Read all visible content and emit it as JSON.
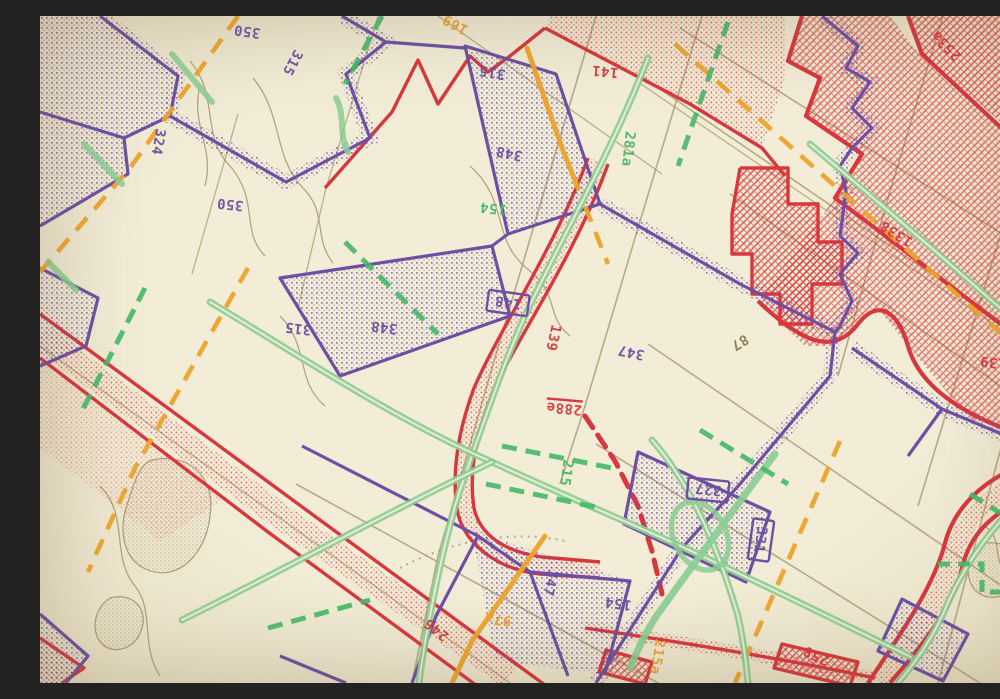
{
  "image": {
    "alt": "Close-up photograph of a printed zoning map with purple, red, green and orange district boundaries, halftone fills, dashed lines and rotated district numbers on cream paper",
    "width": 1000,
    "height": 667
  },
  "palette": {
    "paper": "#f3edd8",
    "paper_edge": "#e6ddc2",
    "purple": "#6f4fa3",
    "red": "#d8383d",
    "green": "#45b868",
    "green_road": "#8acd93",
    "orange": "#eca32d",
    "tan": "#a89870",
    "tan_dark": "#8a7c55"
  },
  "labels": [
    {
      "text": "350",
      "x": 207,
      "y": 16,
      "rot": 188,
      "color": "purple"
    },
    {
      "text": "315",
      "x": 253,
      "y": 47,
      "rot": 118,
      "color": "purple"
    },
    {
      "text": "324",
      "x": 119,
      "y": 126,
      "rot": 100,
      "color": "purple"
    },
    {
      "text": "350",
      "x": 190,
      "y": 189,
      "rot": 186,
      "color": "purple"
    },
    {
      "text": "169",
      "x": 415,
      "y": 9,
      "rot": 208,
      "color": "orange"
    },
    {
      "text": "315",
      "x": 452,
      "y": 57,
      "rot": 190,
      "color": "purple"
    },
    {
      "text": "141",
      "x": 565,
      "y": 56,
      "rot": 186,
      "color": "red"
    },
    {
      "text": "253a",
      "x": 906,
      "y": 30,
      "rot": 225,
      "color": "red"
    },
    {
      "text": "348",
      "x": 469,
      "y": 138,
      "rot": 192,
      "color": "purple"
    },
    {
      "text": "154",
      "x": 453,
      "y": 193,
      "rot": 186,
      "color": "green"
    },
    {
      "text": "281a",
      "x": 589,
      "y": 133,
      "rot": 96,
      "color": "green"
    },
    {
      "text": "315",
      "x": 258,
      "y": 313,
      "rot": 187,
      "color": "purple"
    },
    {
      "text": "348",
      "x": 344,
      "y": 312,
      "rot": 187,
      "color": "purple"
    },
    {
      "text": "148",
      "x": 468,
      "y": 287,
      "rot": 188,
      "color": "purple",
      "boxed": true
    },
    {
      "text": "139",
      "x": 514,
      "y": 322,
      "rot": 102,
      "color": "red"
    },
    {
      "text": "347",
      "x": 591,
      "y": 337,
      "rot": 192,
      "color": "purple"
    },
    {
      "text": "288e",
      "x": 524,
      "y": 393,
      "rot": 185,
      "color": "red",
      "underline": true
    },
    {
      "text": "87",
      "x": 700,
      "y": 327,
      "rot": 148,
      "color": "tan"
    },
    {
      "text": "1338",
      "x": 856,
      "y": 218,
      "rot": 212,
      "color": "red"
    },
    {
      "text": "139",
      "x": 953,
      "y": 347,
      "rot": 186,
      "color": "red"
    },
    {
      "text": "356",
      "x": 977,
      "y": 424,
      "rot": 190,
      "color": "purple"
    },
    {
      "text": "327",
      "x": 668,
      "y": 474,
      "rot": 186,
      "color": "purple",
      "boxed": true
    },
    {
      "text": "331",
      "x": 721,
      "y": 524,
      "rot": 98,
      "color": "purple",
      "boxed": true
    },
    {
      "text": "215",
      "x": 527,
      "y": 457,
      "rot": 98,
      "color": "green"
    },
    {
      "text": "347",
      "x": 511,
      "y": 567,
      "rot": 102,
      "color": "purple"
    },
    {
      "text": "154",
      "x": 578,
      "y": 588,
      "rot": 188,
      "color": "purple"
    },
    {
      "text": "97a",
      "x": 458,
      "y": 604,
      "rot": 188,
      "color": "orange"
    },
    {
      "text": "246",
      "x": 396,
      "y": 614,
      "rot": 218,
      "color": "red"
    },
    {
      "text": "215a",
      "x": 618,
      "y": 641,
      "rot": 100,
      "color": "orange"
    },
    {
      "text": "258",
      "x": 776,
      "y": 640,
      "rot": 205,
      "color": "red"
    }
  ]
}
